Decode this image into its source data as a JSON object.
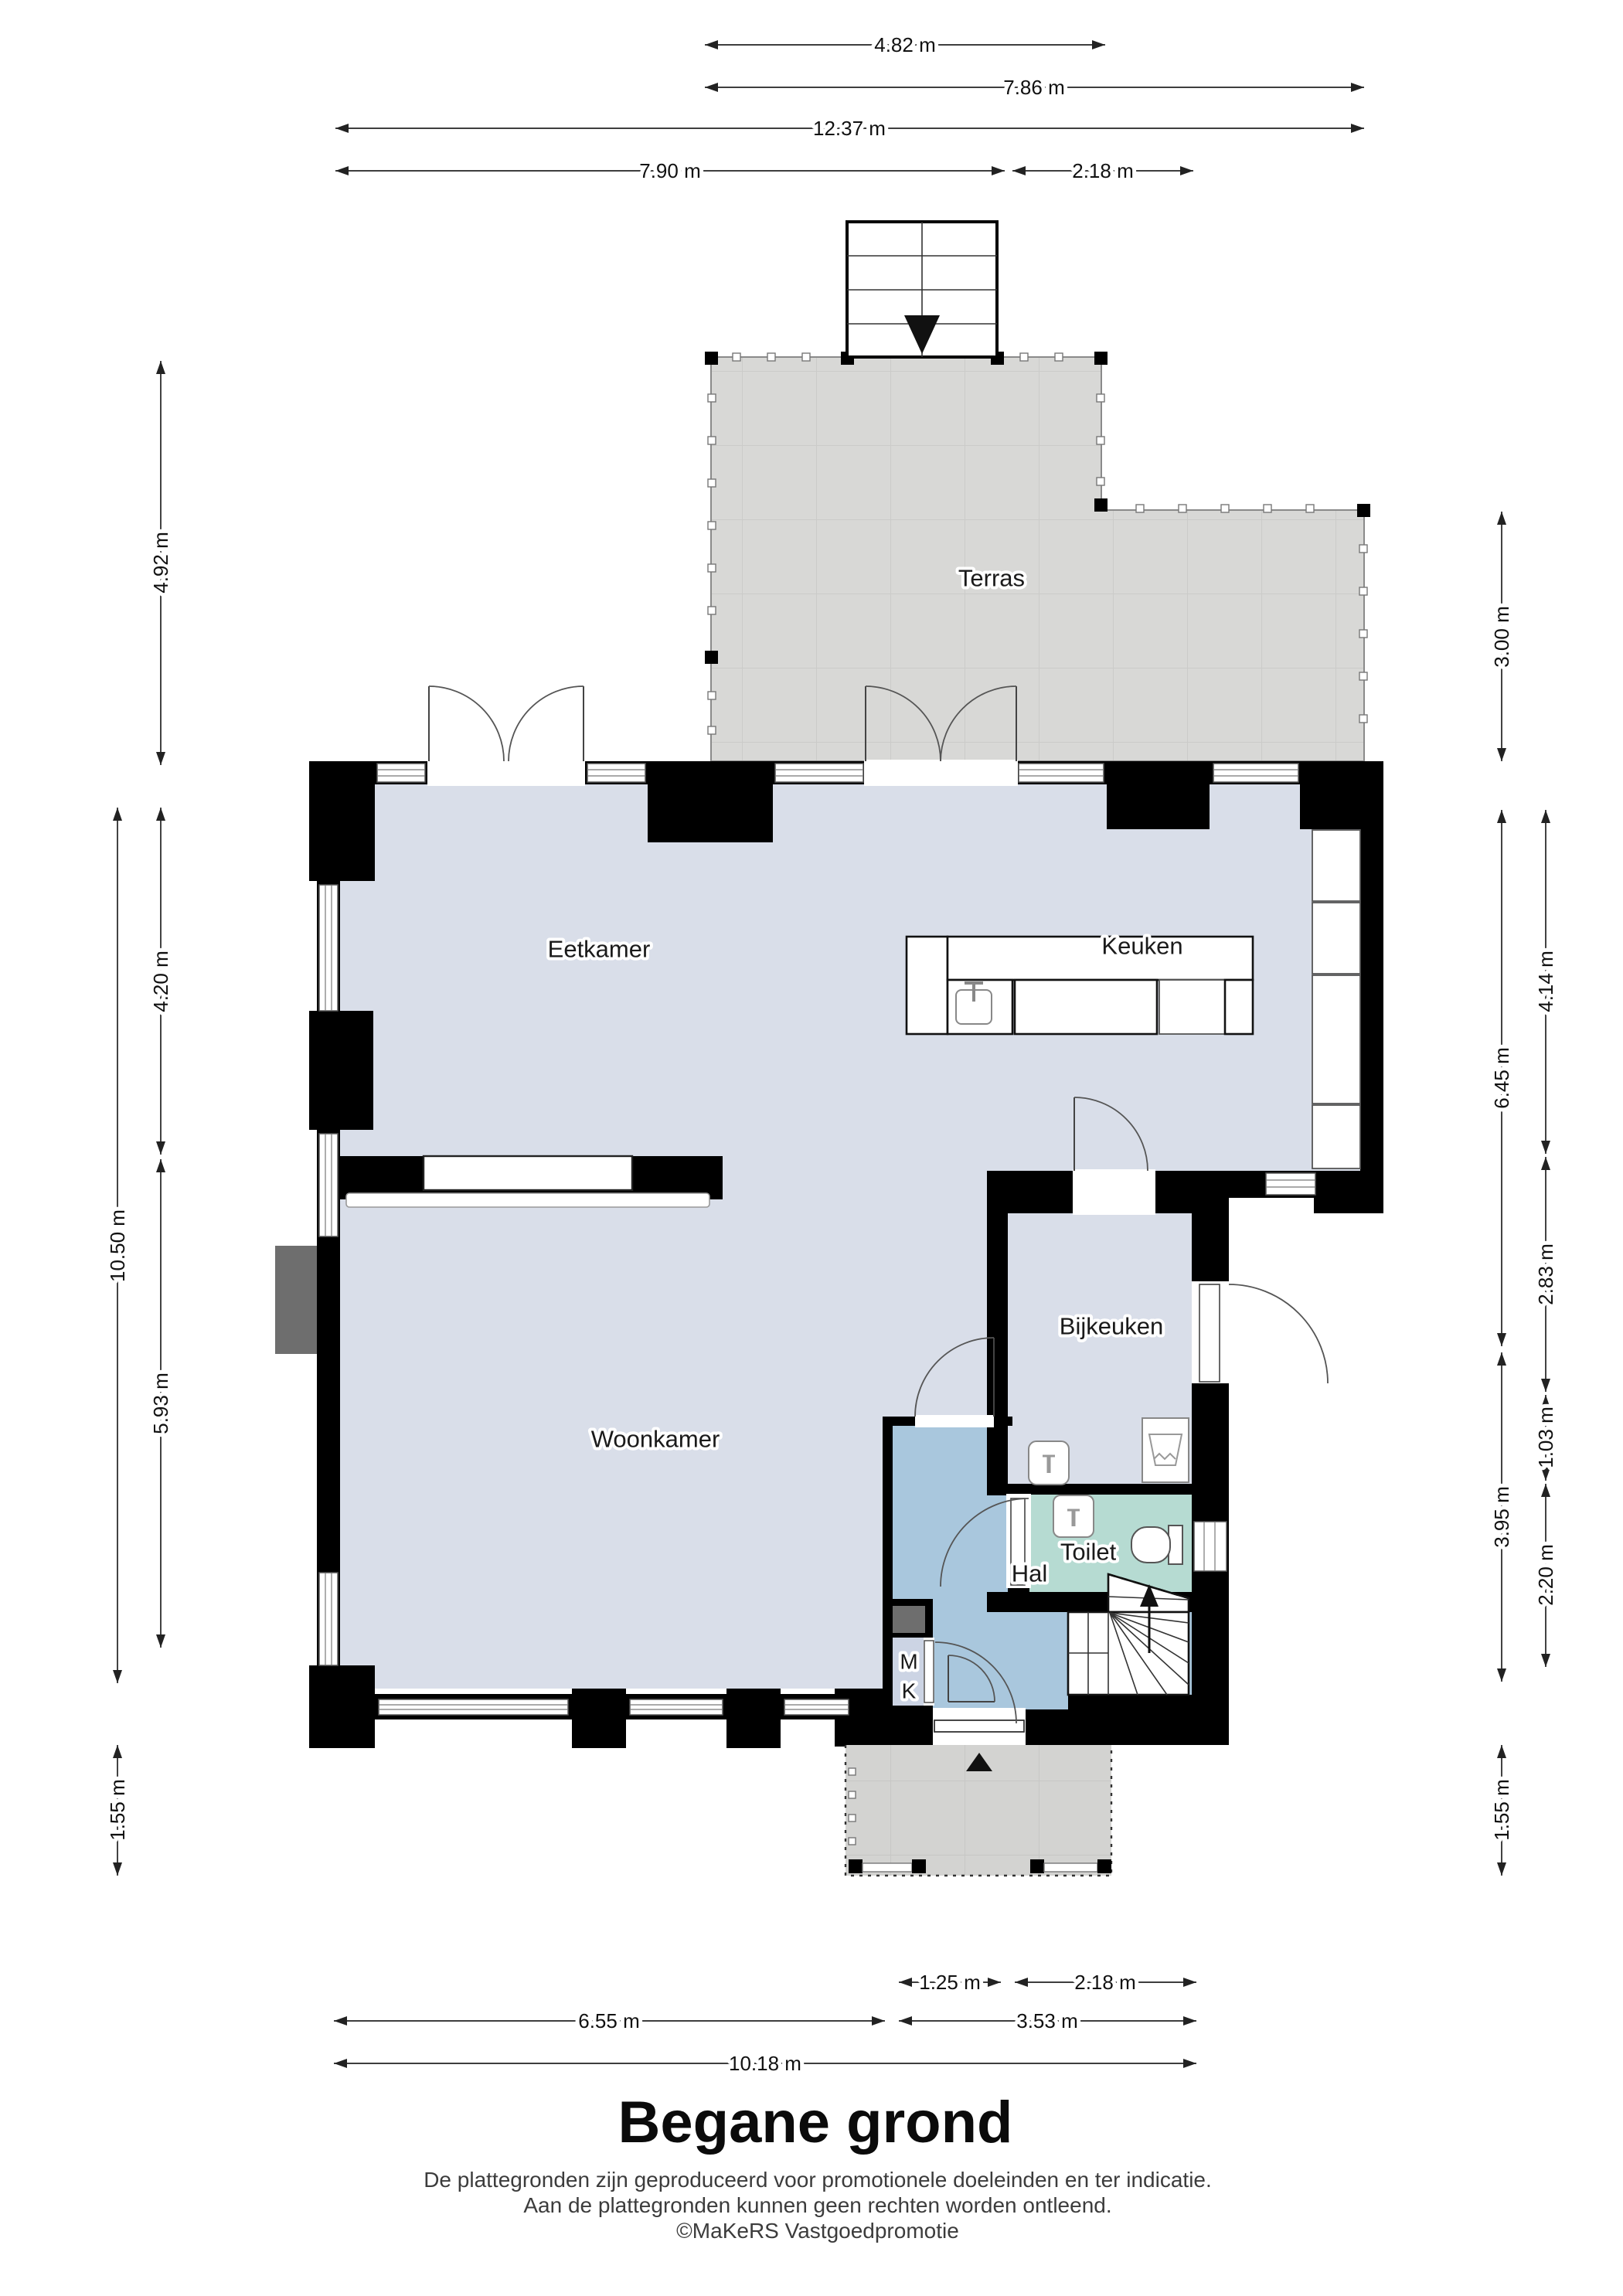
{
  "page": {
    "title": "Begane grond",
    "disclaimer1": "De plattegronden zijn geproduceerd voor promotionele doeleinden en ter indicatie.",
    "disclaimer2": "Aan de plattegronden kunnen geen rechten worden ontleend.",
    "copyright": "©MaKeRS Vastgoedpromotie"
  },
  "rooms": {
    "terras": "Terras",
    "keuken": "Keuken",
    "eetkamer": "Eetkamer",
    "bijkeuken": "Bijkeuken",
    "woonkamer": "Woonkamer",
    "toilet": "Toilet",
    "hal": "Hal",
    "mk_line1": "M",
    "mk_line2": "K"
  },
  "dimensions": {
    "top": [
      "4.82 m",
      "7.86 m",
      "12.37 m",
      "7.90 m",
      "2.18 m"
    ],
    "left": [
      "4.92 m",
      "10.50 m",
      "4.20 m",
      "5.93 m",
      "1.55 m"
    ],
    "right": [
      "3.00 m",
      "6.45 m",
      "4.14 m",
      "2.83 m",
      "1.03 m",
      "3.95 m",
      "2.20 m",
      "1.55 m"
    ],
    "bottom": [
      "1.25 m",
      "2.18 m",
      "6.55 m",
      "3.53 m",
      "10.18 m"
    ]
  },
  "colors": {
    "floor": "#d9dee9",
    "hal": "#a9c7dd",
    "toilet": "#b6dbd2",
    "mk": "#ccd4e4",
    "terras": "#d8d8d6",
    "porch": "#d3d3d1",
    "wall": "#000000",
    "meter_gray": "#6e6e6e",
    "chimney_gray": "#6e6e6e"
  }
}
